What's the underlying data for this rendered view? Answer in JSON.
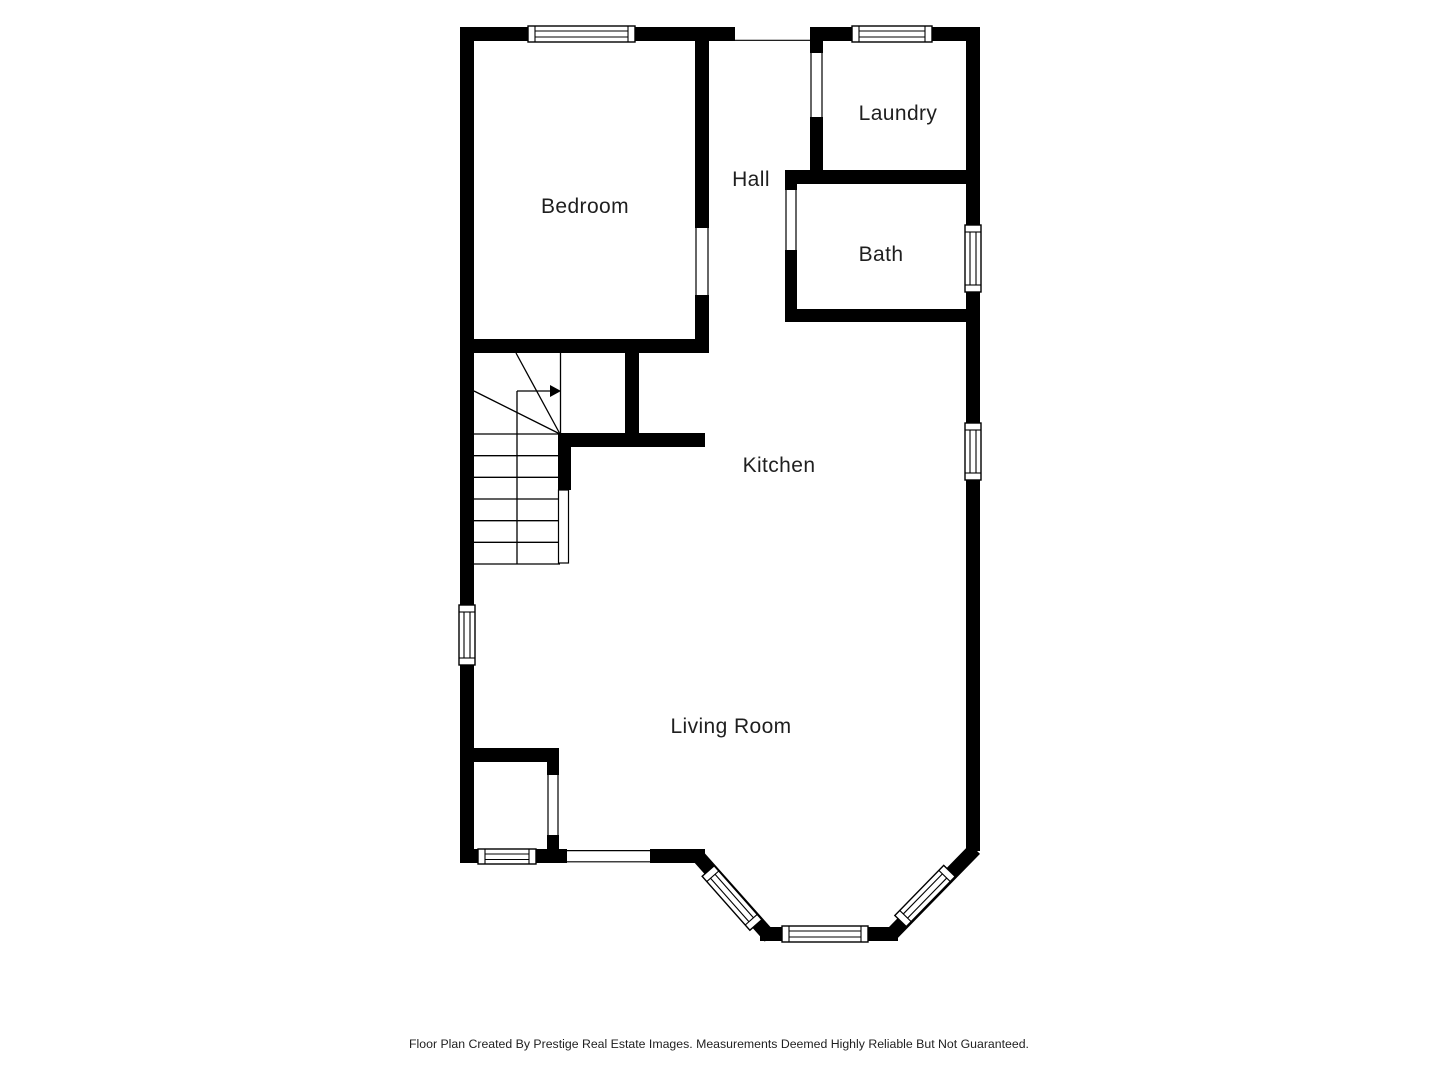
{
  "palette": {
    "wall": "#000000",
    "background": "#ffffff",
    "text": "#1f1f1f"
  },
  "floor_plan": {
    "rooms": [
      {
        "name": "Bedroom"
      },
      {
        "name": "Hall"
      },
      {
        "name": "Laundry"
      },
      {
        "name": "Bath"
      },
      {
        "name": "Kitchen"
      },
      {
        "name": "Living Room"
      }
    ]
  },
  "footer": {
    "credit": "Floor Plan Created By Prestige Real Estate Images. Measurements Deemed Highly Reliable But Not Guaranteed."
  }
}
